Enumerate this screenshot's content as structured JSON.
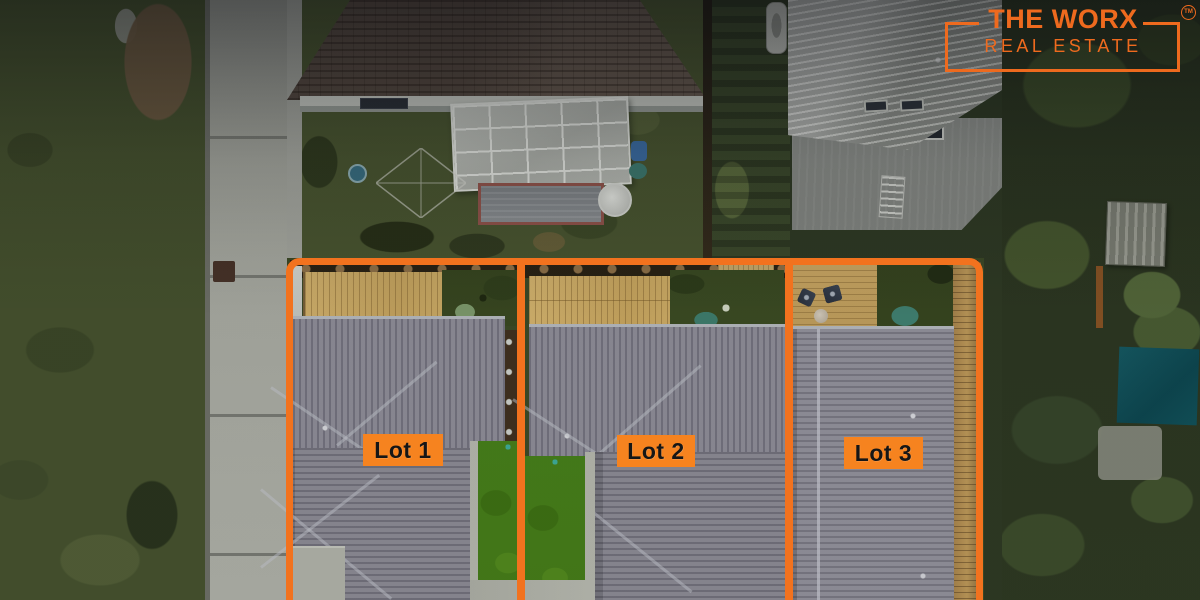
{
  "brand": {
    "line1": "THE WORX",
    "line2": "REAL ESTATE",
    "trademark": "TM",
    "accent_color": "#EE6A1E"
  },
  "lots": [
    {
      "label": "Lot 1"
    },
    {
      "label": "Lot 2"
    },
    {
      "label": "Lot 3"
    }
  ],
  "overlay": {
    "boundary_color": "#F2721E",
    "label_background": "#F6831F",
    "label_text_color": "#161616"
  }
}
